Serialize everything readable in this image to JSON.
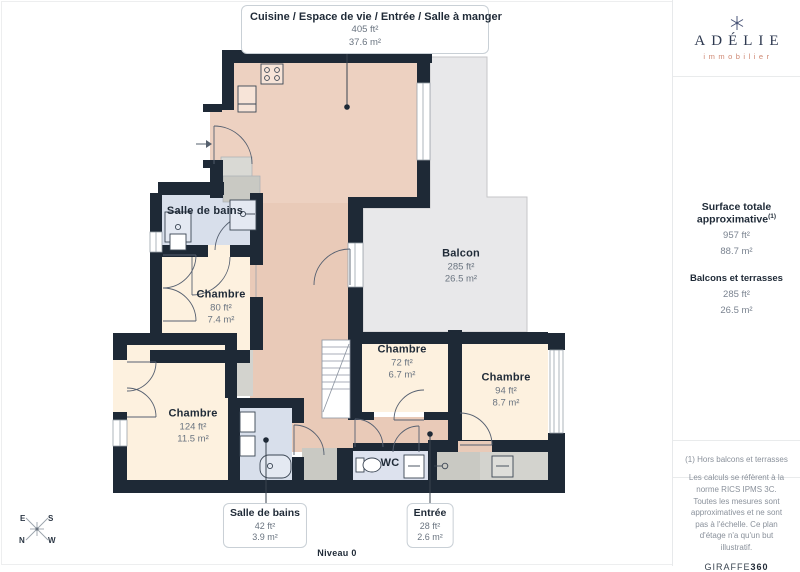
{
  "plan": {
    "main_area": {
      "title": "Cuisine / Espace de vie / Entrée / Salle à manger",
      "ft": "405 ft²",
      "m": "37.6 m²"
    },
    "rooms": {
      "bath_upper": {
        "name": "Salle de bains"
      },
      "chambre_80": {
        "name": "Chambre",
        "ft": "80 ft²",
        "m": "7.4 m²"
      },
      "balcon": {
        "name": "Balcon",
        "ft": "285 ft²",
        "m": "26.5 m²"
      },
      "chambre_72": {
        "name": "Chambre",
        "ft": "72 ft²",
        "m": "6.7 m²"
      },
      "chambre_94": {
        "name": "Chambre",
        "ft": "94 ft²",
        "m": "8.7 m²"
      },
      "chambre_124": {
        "name": "Chambre",
        "ft": "124 ft²",
        "m": "11.5 m²"
      },
      "wc": {
        "name": "WC"
      }
    },
    "callouts": {
      "bath_lower": {
        "name": "Salle de bains",
        "ft": "42 ft²",
        "m": "3.9 m²"
      },
      "entree": {
        "name": "Entrée",
        "ft": "28 ft²",
        "m": "2.6 m²"
      }
    },
    "level": "Niveau 0",
    "compass": {
      "n": "N",
      "s": "S",
      "e": "E",
      "w": "W"
    }
  },
  "sidebar": {
    "brand": {
      "name": "ADÉLIE",
      "tagline": "immobilier"
    },
    "surface": {
      "title": "Surface totale approximative",
      "sup": "(1)",
      "ft": "957 ft²",
      "m": "88.7 m²"
    },
    "balconies": {
      "title": "Balcons et terrasses",
      "ft": "285 ft²",
      "m": "26.5 m²"
    },
    "footnote": "(1) Hors balcons et terrasses",
    "legal": "Les calculs se réfèrent à la norme RICS IPMS 3C. Toutes les mesures sont approximatives et ne sont pas à l'échelle. Ce plan d'étage n'a qu'un but illustratif.",
    "watermark": {
      "text": "GIRAFFE",
      "suffix": "360"
    }
  },
  "colors": {
    "wall": "#1e2936",
    "living": "#edd1c1",
    "hall": "#e9cab8",
    "bedroom": "#fdf1df",
    "bath": "#d8dfeb",
    "balcony": "#e8e8ea",
    "closet": "#c9c9c3",
    "brand_navy": "#2e3950",
    "brand_salmon": "#cf8873"
  }
}
